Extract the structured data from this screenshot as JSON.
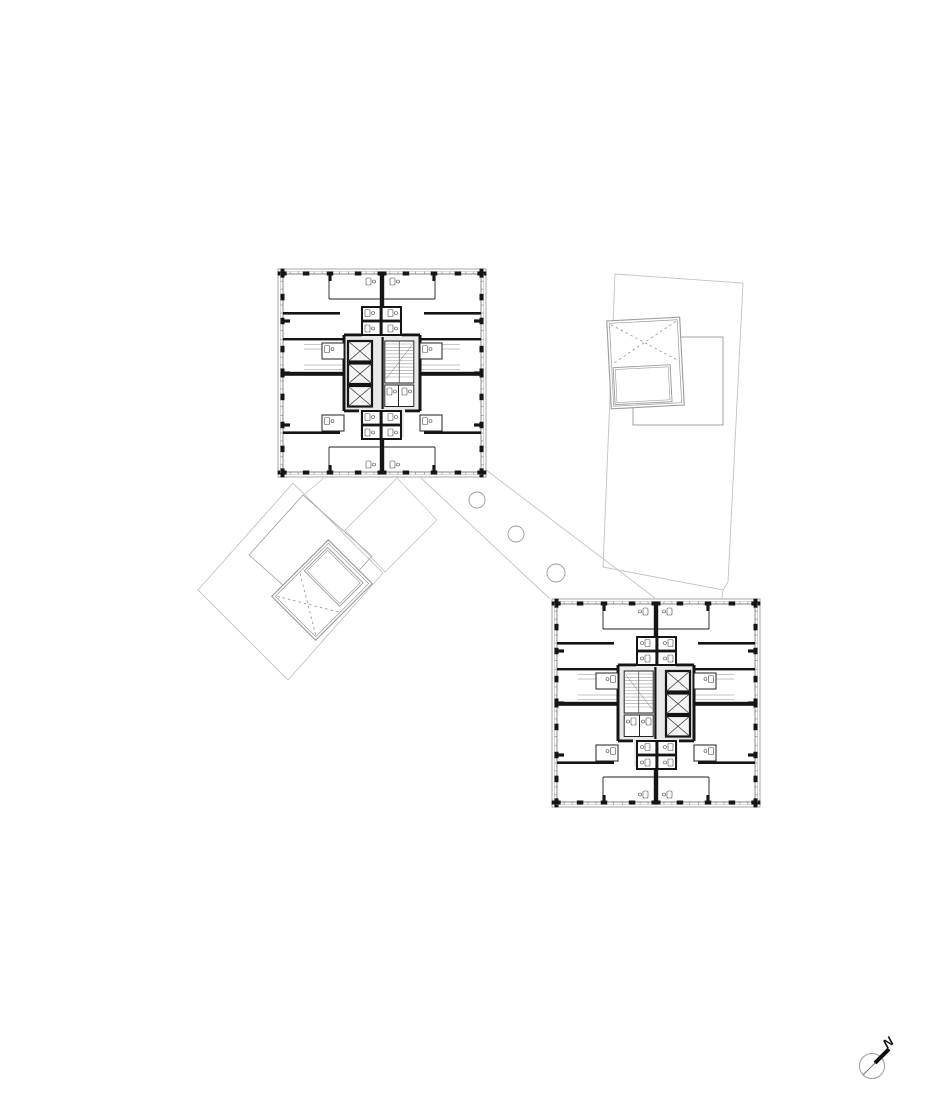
{
  "page": {
    "width": 952,
    "height": 1100,
    "background": "#ffffff",
    "kind": "architectural-floor-plan"
  },
  "colors": {
    "wall": "#151515",
    "thin_line": "#3a3a3a",
    "boundary": "#8f8f8f",
    "window_line": "#5a5a5a",
    "glazing": "#b5b5b5",
    "light_outline": "#c2c2c2",
    "medium_outline": "#9a9a9a",
    "core_fill": "#e9e9e9",
    "shaft_fill": "#f4f4f4",
    "tread": "#9a9a9a",
    "fixture": "#474747"
  },
  "plan": {
    "towers": [
      {
        "name": "tower-northwest",
        "x": 278,
        "y": 269,
        "size": 208,
        "mirrored": false,
        "elevators": 3,
        "stair": true
      },
      {
        "name": "tower-southeast",
        "x": 552,
        "y": 599,
        "size": 208,
        "mirrored": true,
        "elevators": 3,
        "stair": true
      }
    ],
    "walkway": {
      "edges": [
        [
          486,
          470,
          655,
          598
        ],
        [
          421,
          478,
          550,
          599
        ]
      ],
      "columns": [
        [
          477,
          500,
          8
        ],
        [
          516,
          534,
          8
        ],
        [
          556,
          573,
          9
        ]
      ]
    },
    "ne_building": {
      "outline": [
        [
          615,
          274
        ],
        [
          743,
          283
        ],
        [
          728,
          582
        ],
        [
          723,
          590
        ],
        [
          603,
          567
        ]
      ],
      "inner_rect": [
        633,
        337,
        90,
        88
      ],
      "tick": [
        723,
        590,
        722,
        599
      ],
      "skylight": {
        "x": 609,
        "y": 319,
        "w": 73,
        "h": 88,
        "rot": -3,
        "split": 45,
        "x_half": "top",
        "inner": [
          4,
          47,
          57,
          37
        ]
      }
    },
    "sw_building": {
      "outer_diamond": [
        [
          293,
          483
        ],
        [
          198,
          590
        ],
        [
          288,
          680
        ],
        [
          383,
          573
        ]
      ],
      "small_diamond": [
        [
          397,
          478
        ],
        [
          437,
          520
        ],
        [
          385,
          572
        ],
        [
          345,
          530
        ]
      ],
      "middle_rect": [
        [
          303,
          495
        ],
        [
          372,
          556
        ],
        [
          318,
          616
        ],
        [
          249,
          555
        ]
      ],
      "connector": [
        324,
        478,
        305,
        494
      ],
      "skylight": {
        "x": 291,
        "y": 550,
        "w": 62,
        "h": 80,
        "rot": 45,
        "cx": 322,
        "cy": 590,
        "split": 42,
        "x_half": "bottom",
        "inner": [
          5,
          6,
          50,
          33
        ]
      }
    },
    "north_arrow": {
      "cx": 872,
      "cy": 1066,
      "r": 12.5,
      "label": "N",
      "line": [
        863,
        1075,
        877,
        1061
      ],
      "bold_line": [
        875,
        1063,
        889,
        1049
      ],
      "label_x": 891,
      "label_y": 1046,
      "label_rot": -40
    }
  }
}
